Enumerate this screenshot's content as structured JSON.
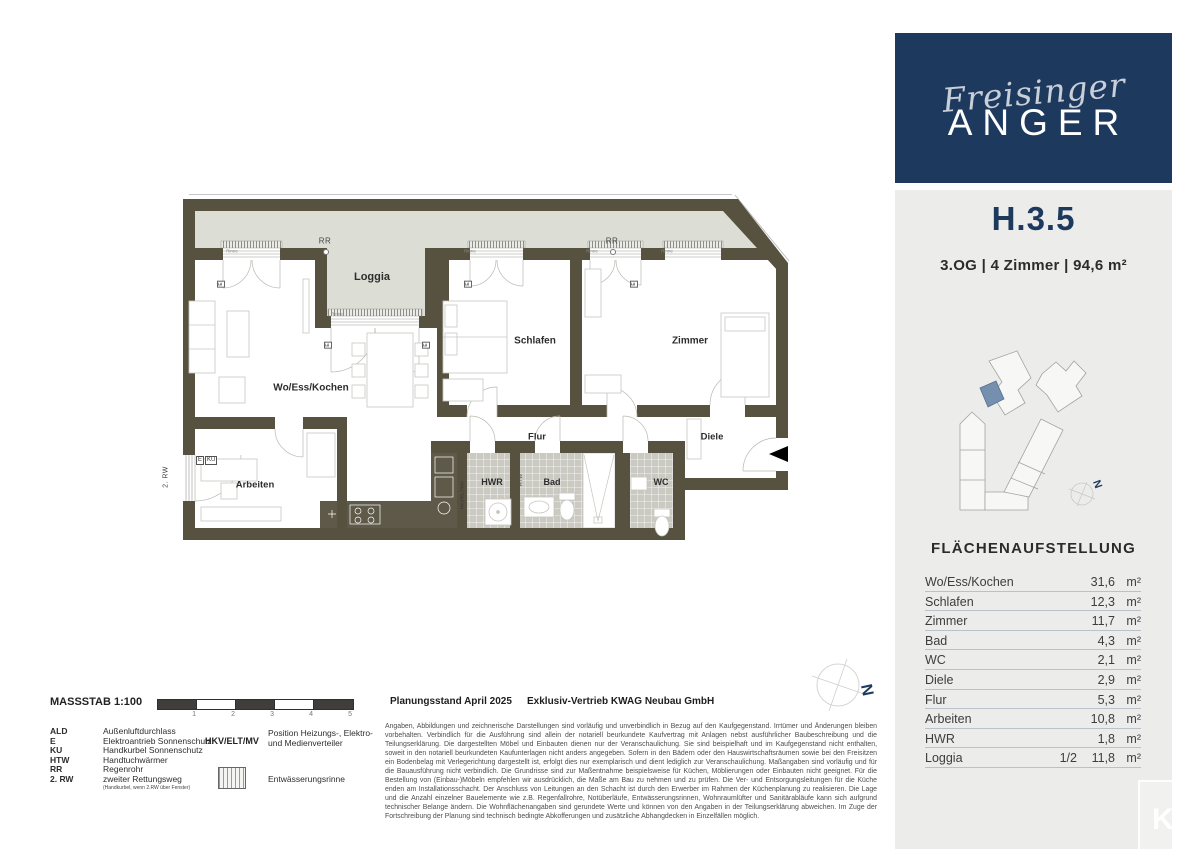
{
  "brand": {
    "script": "Freisinger",
    "name": "ANGER"
  },
  "unit": {
    "id": "H.3.5",
    "details": "3.OG | 4 Zimmer | 94,6 m²"
  },
  "site_plan": {
    "north_label": "N"
  },
  "area_table": {
    "title": "FLÄCHENAUFSTELLUNG",
    "unit_label": "m²",
    "rows": [
      {
        "label": "Wo/Ess/Kochen",
        "factor": "",
        "value": "31,6"
      },
      {
        "label": "Schlafen",
        "factor": "",
        "value": "12,3"
      },
      {
        "label": "Zimmer",
        "factor": "",
        "value": "11,7"
      },
      {
        "label": "Bad",
        "factor": "",
        "value": "4,3"
      },
      {
        "label": "WC",
        "factor": "",
        "value": "2,1"
      },
      {
        "label": "Diele",
        "factor": "",
        "value": "2,9"
      },
      {
        "label": "Flur",
        "factor": "",
        "value": "5,3"
      },
      {
        "label": "Arbeiten",
        "factor": "",
        "value": "10,8"
      },
      {
        "label": "HWR",
        "factor": "",
        "value": "1,8"
      },
      {
        "label": "Loggia",
        "factor": "1/2",
        "value": "11,8"
      }
    ]
  },
  "floor_plan": {
    "labels": {
      "loggia": "Loggia",
      "wohnen": "Wo/Ess/Kochen",
      "schlafen": "Schlafen",
      "zimmer": "Zimmer",
      "arbeiten": "Arbeiten",
      "flur": "Flur",
      "diele": "Diele",
      "hwr": "HWR",
      "bad": "Bad",
      "wc": "WC"
    },
    "markers": {
      "rr": "RR",
      "rinne": "Rinne",
      "e": "E",
      "ku": "KU",
      "rw": "2. RW",
      "hkv": "HKV/ELT/MV",
      "htw": "HTW",
      "north": "N"
    }
  },
  "legend": {
    "massstab": "MASSSTAB 1:100",
    "scale_ticks": [
      "1",
      "2",
      "3",
      "4",
      "5"
    ],
    "abbreviations": [
      {
        "abbr": "ALD",
        "text": "Außenluftdurchlass"
      },
      {
        "abbr": "E",
        "text": "Elektroantrieb Sonnenschutz"
      },
      {
        "abbr": "KU",
        "text": "Handkurbel Sonnenschutz"
      },
      {
        "abbr": "HTW",
        "text": "Handtuchwärmer"
      },
      {
        "abbr": "RR",
        "text": "Regenrohr"
      },
      {
        "abbr": "2. RW",
        "text": "zweiter Rettungsweg",
        "note": "(Handkurbel, wenn 2.RW über Fenster)"
      }
    ],
    "hkv": {
      "abbr": "HKV/ELT/MV",
      "text": "Position Heizungs-, Elektro- und Medienverteiler"
    },
    "rinne_label": "Entwässerungsrinne"
  },
  "footer": {
    "planning": "Planungsstand April 2025",
    "sales": "Exklusiv-Vertrieb KWAG Neubau GmbH",
    "disclaimer": "Angaben, Abbildungen und zeichnerische Darstellungen sind vorläufig und unverbindlich in Bezug auf den Kaufgegenstand. Irrtümer und Änderungen bleiben vorbehalten. Verbindlich für die Ausführung sind allein der notariell beurkundete Kaufvertrag mit Anlagen nebst ausführlicher Baubeschreibung und die Teilungserklärung. Die dargestellten Möbel und Einbauten dienen nur der Veranschaulichung. Sie sind beispielhaft und im Kaufgegenstand nicht enthalten, soweit in den notariell beurkundeten Kaufunterlagen nicht anders angegeben. Sofern in den Bädern oder den Hauswirtschaftsräumen sowie bei den Freisitzen ein Bodenbelag mit Verlegerichtung dargestellt ist, erfolgt dies nur exemplarisch und dient lediglich zur Veranschaulichung. Maßangaben sind vorläufig und für die Bauausführung nicht verbindlich. Die Grundrisse sind zur Maßentnahme beispielsweise für Küchen, Möblierungen oder Einbauten nicht geeignet. Für die Bestellung von (Einbau-)Möbeln empfehlen wir ausdrücklich, die Maße am Bau zu nehmen und zu prüfen. Die Ver- und Entsorgungsleitungen für die Küche enden am Installationsschacht. Der Anschluss von Leitungen an den Schacht ist durch den Erwerber im Rahmen der Küchenplanung zu realisieren. Die Lage und die Anzahl einzelner Bauelemente wie z.B. Regenfallrohre, Notüberläufe, Entwässerungsrinnen, Wohnraumlüfter und Sanitärabläufe kann sich aufgrund technischer Belange ändern. Die Wohnflächenangaben sind gerundete Werte und können von den Angaben in der Teilungserklärung abweichen. Im Zuge der Fortschreibung der Planung sind technisch bedingte Abkofferungen und zusätzliche Abhangdecken in Einzelfällen möglich."
  },
  "watermark": "KW"
}
